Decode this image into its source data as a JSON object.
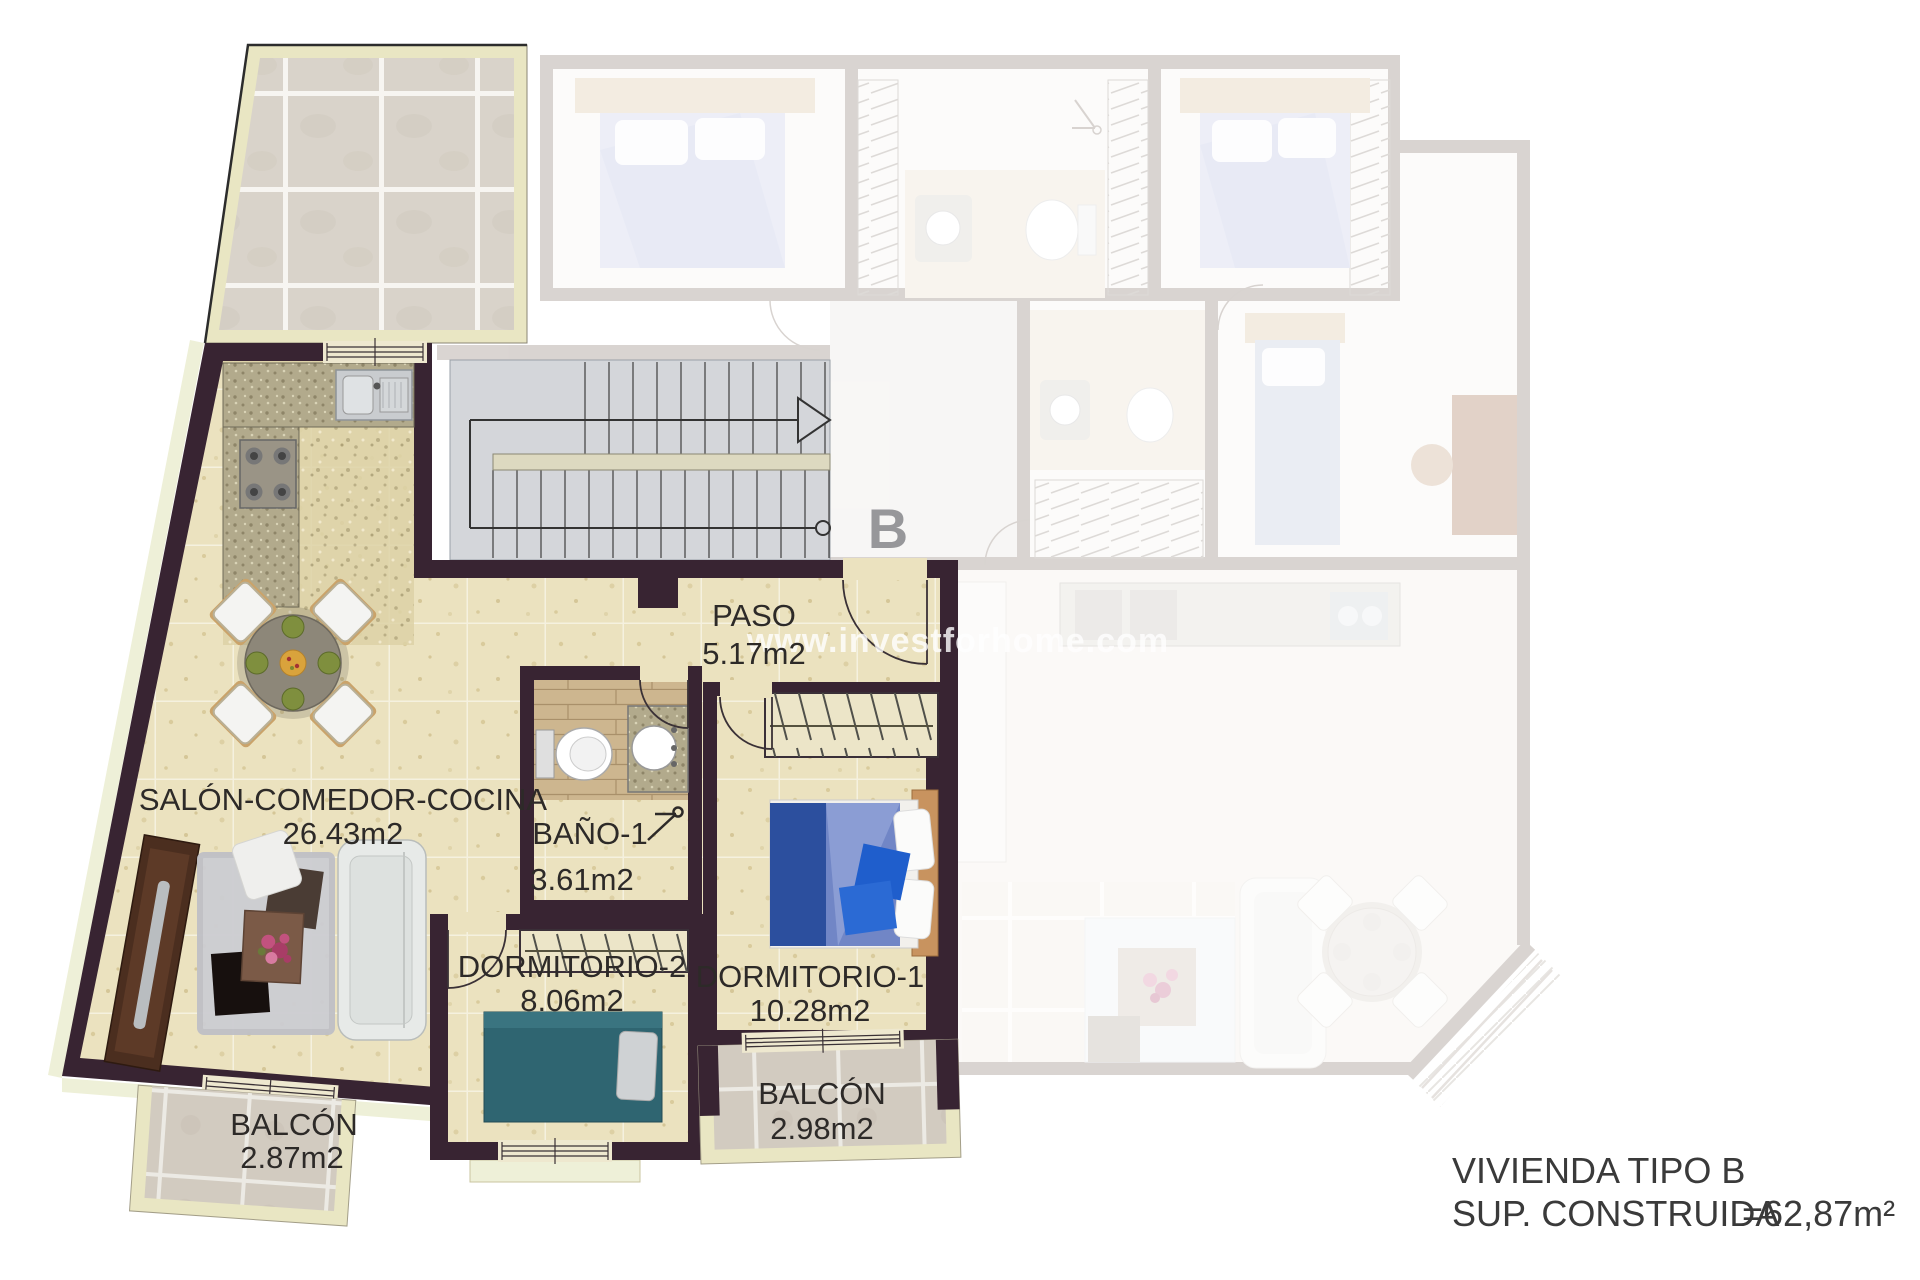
{
  "watermark": {
    "text": "www.investforhome.com"
  },
  "stairwell": {
    "unit_letter": "B"
  },
  "rooms": [
    {
      "name": "SALÓN-COMEDOR-COCINA",
      "area": "26.43m2"
    },
    {
      "name": "PASO",
      "area": "5.17m2"
    },
    {
      "name": "BAÑO-1",
      "area": "3.61m2"
    },
    {
      "name": "DORMITORIO-2",
      "area": "8.06m2"
    },
    {
      "name": "DORMITORIO-1",
      "area": "10.28m2"
    },
    {
      "name": "BALCÓN",
      "area": "2.87m2"
    },
    {
      "name": "BALCÓN",
      "area": "2.98m2"
    }
  ],
  "title_block": {
    "line1": "VIVIENDA TIPO B",
    "line2": "SUP. CONSTRUIDA",
    "value": "=62,87m²"
  },
  "colors": {
    "active_wall": "#382432",
    "active_floor": "#ebe2bf",
    "terrace_border": "#e9e6c3",
    "stair_floor": "#d4d6da",
    "faded_wall": "#8f8077",
    "label_text": "#2d2a28"
  }
}
